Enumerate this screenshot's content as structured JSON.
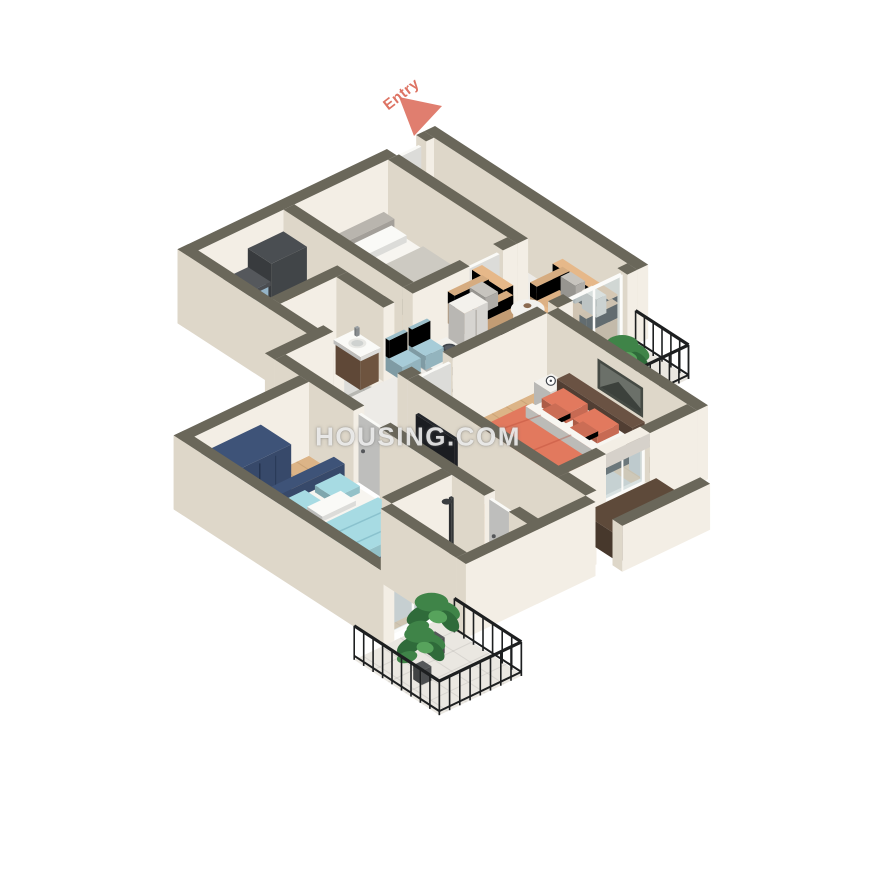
{
  "watermark": {
    "text": "HOUSING.COM"
  },
  "entry": {
    "label": "Entry",
    "arrow_color": "#dd7363"
  },
  "palette": {
    "background": "#ffffff",
    "wall_top": "#6a675a",
    "wall_face": "#f3eee5",
    "wall_face_shadow": "#ded7c9",
    "floor_wood": "#dcb487",
    "floor_marble": "#edebe7",
    "floor_tile": "#b7b7b2",
    "floor_balcony": "#eae7e1",
    "kitchen_cabinet": "#a9cde2",
    "counter_dark": "#55585c",
    "island_top": "#eff0ee",
    "sink_copper": "#8a5a33",
    "fridge_dark": "#4a4e52",
    "bed_frame_gray": "#b9b5ae",
    "mattress_white": "#f7f5f0",
    "blanket_gray": "#cdcac2",
    "sofa_tan": "#ddb184",
    "pillow_gray": "#c7c4be",
    "table_white": "#f2f1ed",
    "chair_blue": "#a7ccd8",
    "plate_dark": "#3f444b",
    "cabinet_white": "#f3f1ec",
    "master_coral": "#e2795e",
    "headboard_brown": "#6a5243",
    "nightstand_white": "#f4f2ee",
    "rug_gray": "#c9c7c2",
    "rug_white": "#f4f3ef",
    "tv_navy": "#3f567e",
    "tv_screen": "#23262b",
    "bed2_blue": "#a7dbe3",
    "navy_dark": "#3e5378",
    "vanity_brown": "#7d5f48",
    "fixture_white": "#fafaf7",
    "railing_black": "#1d1f20",
    "plant_green": "#3f8448",
    "plant_green_dark": "#2f6b3a",
    "pot_dark": "#55585a",
    "glass_blue": "#c3d8e0",
    "ledge_brown": "#5e4a3a",
    "watermark_color": "#ffffff"
  }
}
